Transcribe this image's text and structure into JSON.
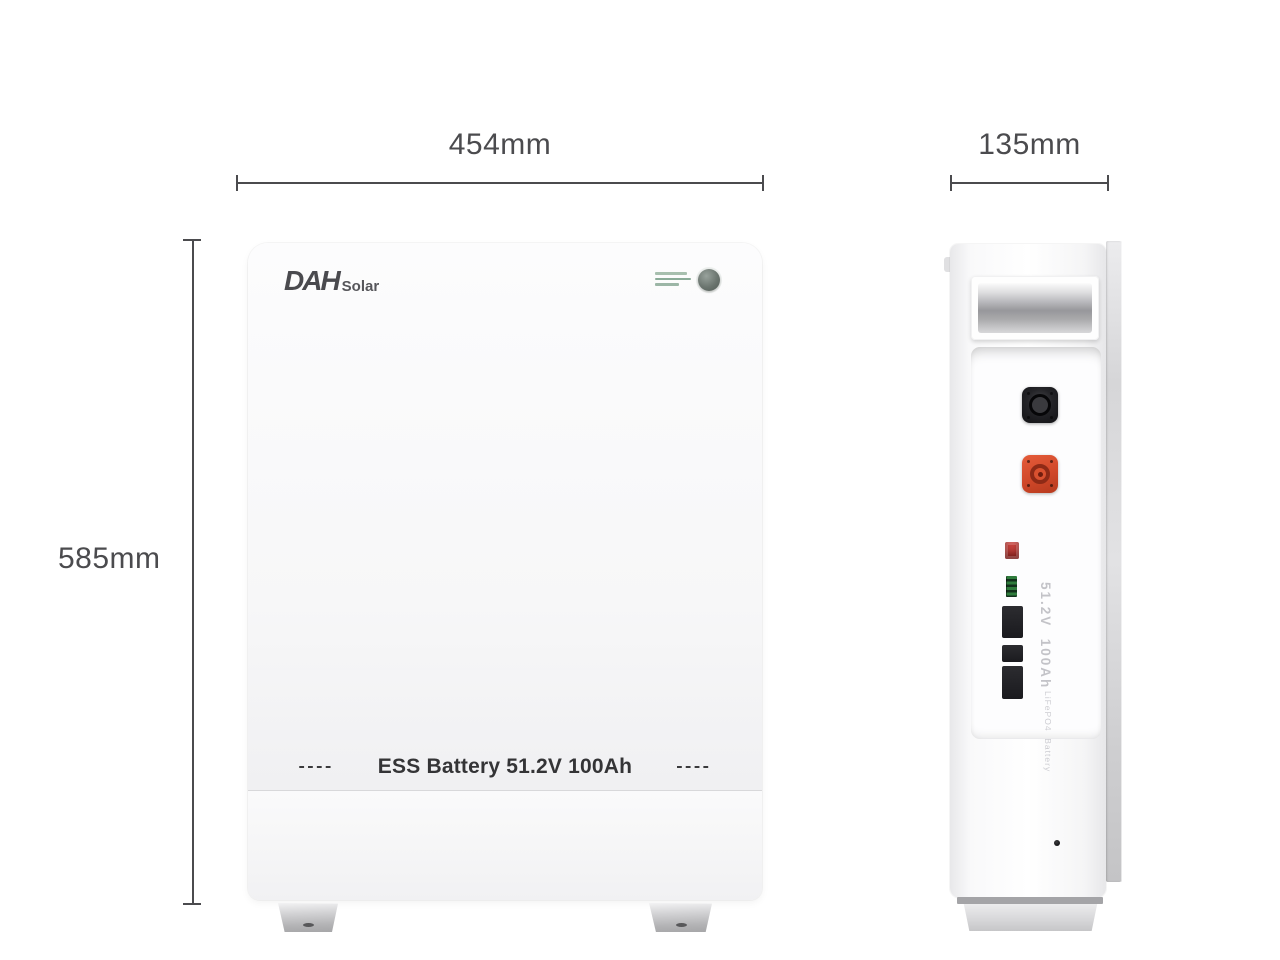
{
  "dimensions": {
    "front_width_label": "454mm",
    "depth_label": "135mm",
    "height_label": "585mm"
  },
  "front_view": {
    "logo_main": "DAH",
    "logo_sub": "Solar",
    "dash_left": "----",
    "product_label": "ESS Battery 51.2V 100Ah",
    "dash_right": "----"
  },
  "side_view": {
    "spec_primary": "51.2V  100Ah",
    "spec_secondary": "LiFePO4  Battery"
  },
  "colors": {
    "dim_line": "#4b4b4e",
    "label_text": "#343436",
    "connector_orange": "#d04829",
    "connector_black": "#1d1d21",
    "switch_red": "#cb4540",
    "terminal_green": "#2f7c3c",
    "power_button_gray": "#6b756f"
  }
}
